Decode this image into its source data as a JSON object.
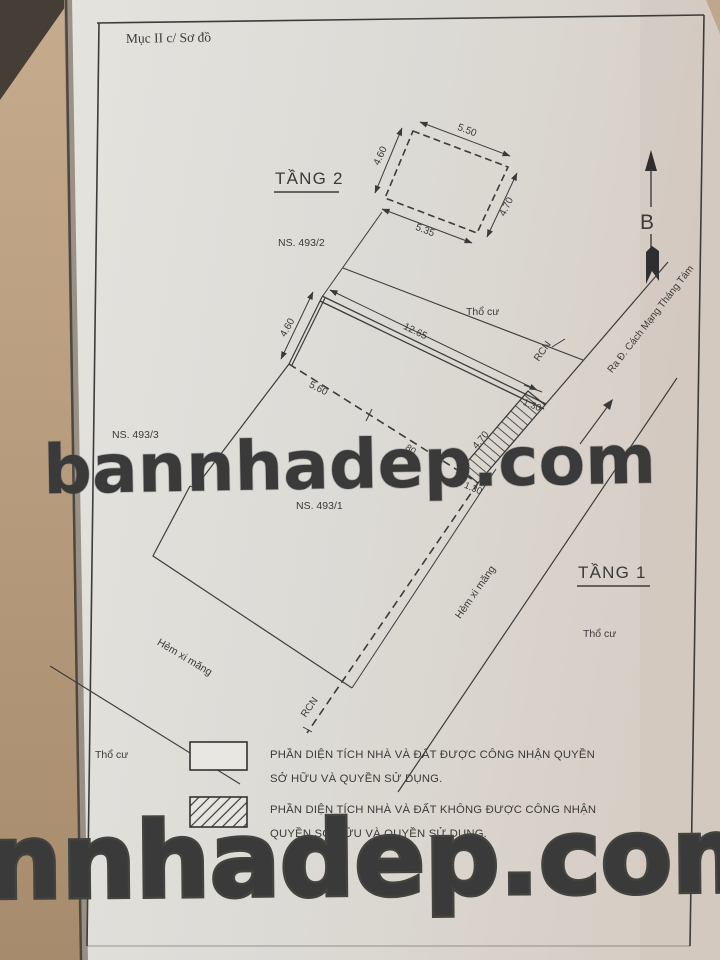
{
  "header": {
    "title": "Mục II c/ Sơ đồ"
  },
  "compass": {
    "label": "B"
  },
  "floor2": {
    "label": "TẦNG 2",
    "parcel": "NS. 493/2",
    "dim_top": "5.50",
    "dim_left": "4.60",
    "dim_right": "4.70",
    "dim_bottom": "5.35"
  },
  "site": {
    "neighbor": "NS. 493/3",
    "house": "NS. 493/1",
    "floor1_label": "TẦNG 1",
    "dim_top": "12.65",
    "dim_left": "4.60",
    "dim_dashed": "5.60",
    "dim_dashed_small": "80",
    "strip_top": "1.30",
    "strip_len": "4.70",
    "strip_bottom": "1.30",
    "rcn_upper": "RCN",
    "rcn_lower": "RCN",
    "tho_cu_top": "Thổ cư",
    "tho_cu_right": "Thổ cư",
    "tho_cu_bottom": "Thổ cư",
    "street": "Ra Đ. Cách Mạng Tháng Tám",
    "alley_right": "Hẻm xi măng",
    "alley_bottom": "Hẻm xi măng"
  },
  "legend": {
    "recognized_line1": "PHẦN DIỆN TÍCH NHÀ VÀ ĐẤT ĐƯỢC CÔNG NHẬN QUYỀN",
    "recognized_line2": "SỞ HỮU VÀ QUYỀN SỬ DỤNG.",
    "not_recognized_line1": "PHẦN DIỆN TÍCH NHÀ VÀ ĐẤT  KHÔNG ĐƯỢC CÔNG NHẬN",
    "not_recognized_line2": "QUYỀN SỞ HỮU VÀ QUYỀN SỬ DỤNG."
  },
  "watermark": {
    "middle": "bannhadep.com",
    "bottom": "nnhadep.com"
  },
  "colors": {
    "ink": "#3a3a3a",
    "paper": "#dfddd8",
    "table": "#b89d81",
    "watermark": "#ffffff"
  }
}
